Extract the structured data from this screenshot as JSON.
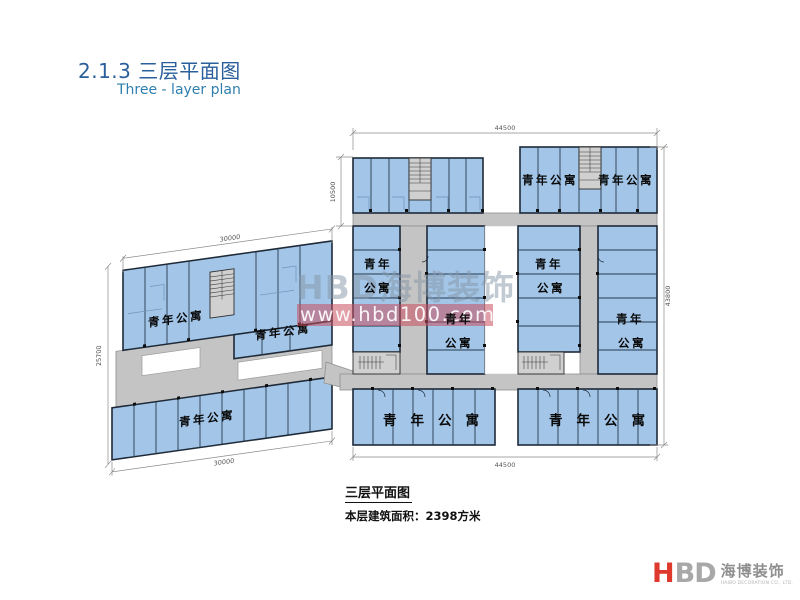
{
  "page": {
    "title": "2.1.3 三层平面图",
    "subtitle": "Three - layer plan"
  },
  "caption": {
    "title": "三层平面图",
    "area_text": "本层建筑面积：2398方米"
  },
  "watermark": {
    "brand": "HBD海博装饰",
    "url": "www.hbd100.com"
  },
  "logo": {
    "h": "H",
    "bd": "BD",
    "name_cn": "海博装饰",
    "name_en": "HAIBO DECORATION CO., LTD."
  },
  "plan": {
    "labels": {
      "apartment": "青年公寓",
      "youth": "青年",
      "apt": "公寓"
    },
    "dimensions": {
      "right_top": "44500",
      "right_bottom": "44500",
      "right_side": "43800",
      "right_upper_left": "10500",
      "left_top": "30000",
      "left_bottom": "30000",
      "left_side": "25700"
    },
    "colors": {
      "room_fill": "#a3c6e8",
      "wall": "#1e2a38",
      "corridor_fill": "#c4c4c4",
      "watermark_band": "#c94f5f",
      "title_blue": "#2a5f9c",
      "logo_red": "#df382c"
    }
  }
}
